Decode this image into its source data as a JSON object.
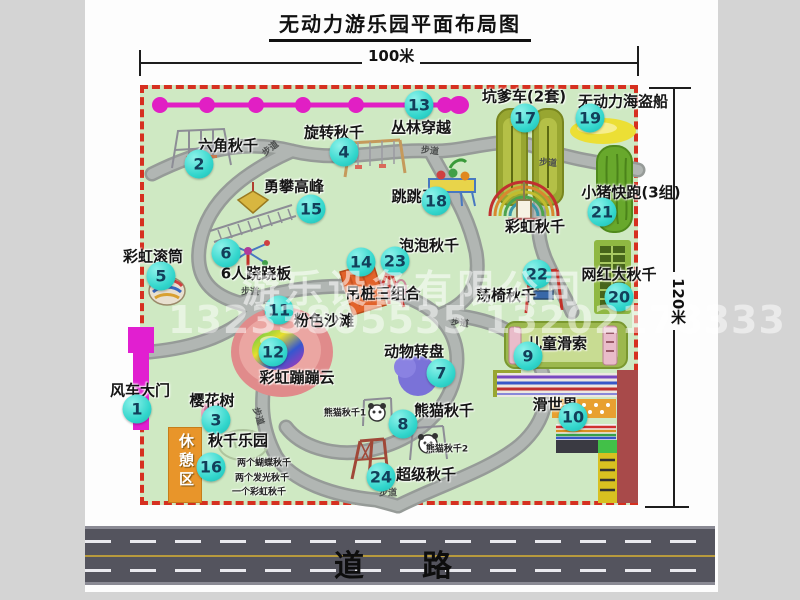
{
  "title": "无动力游乐园平面布局图",
  "dim_top": "100米",
  "dim_right": "120米",
  "road_label": "道　路",
  "trail_label": "步道",
  "rest_area_label": "休憩区",
  "watermark": {
    "company": "游乐设备有限公司",
    "phone": "13233805535 13202178333"
  },
  "attractions": [
    {
      "id": "windmill-gate",
      "num": "1",
      "label": "风车大门",
      "lx": 140,
      "ly": 390,
      "cx": 137,
      "cy": 409
    },
    {
      "id": "hex-swing",
      "num": "2",
      "label": "六角秋千",
      "lx": 228,
      "ly": 145,
      "cx": 199,
      "cy": 164
    },
    {
      "id": "cherry-tree",
      "num": "3",
      "label": "樱花树",
      "lx": 212,
      "ly": 400,
      "cx": 216,
      "cy": 420
    },
    {
      "id": "rotating-swing",
      "num": "4",
      "label": "旋转秋千",
      "lx": 334,
      "ly": 132,
      "cx": 344,
      "cy": 152
    },
    {
      "id": "rainbow-roller",
      "num": "5",
      "label": "彩虹滚筒",
      "lx": 153,
      "ly": 256,
      "cx": 161,
      "cy": 276
    },
    {
      "id": "six-seesaw",
      "num": "6",
      "label": "6人跷跷板",
      "lx": 256,
      "ly": 273,
      "cx": 226,
      "cy": 253
    },
    {
      "id": "animal-turntable",
      "num": "7",
      "label": "动物转盘",
      "lx": 414,
      "ly": 351,
      "cx": 441,
      "cy": 373
    },
    {
      "id": "panda-swing",
      "num": "8",
      "label": "熊猫秋千",
      "lx": 444,
      "ly": 410,
      "cx": 403,
      "cy": 424
    },
    {
      "id": "kids-zipline",
      "num": "9",
      "label": "儿童滑索",
      "lx": 557,
      "ly": 343,
      "cx": 528,
      "cy": 356
    },
    {
      "id": "slide-world",
      "num": "10",
      "label": "滑世界",
      "lx": 555,
      "ly": 404,
      "cx": 573,
      "cy": 417
    },
    {
      "id": "pink-beach",
      "num": "11",
      "label": "粉色沙滩",
      "lx": 324,
      "ly": 320,
      "cx": 279,
      "cy": 310
    },
    {
      "id": "rainbow-bounce-cloud",
      "num": "12",
      "label": "彩虹蹦蹦云",
      "lx": 297,
      "ly": 377,
      "cx": 273,
      "cy": 352
    },
    {
      "id": "jungle-crossing",
      "num": "13",
      "label": "丛林穿越",
      "lx": 421,
      "ly": 127,
      "cx": 419,
      "cy": 105
    },
    {
      "id": "hanging-piles-combo",
      "num": "14",
      "label": "吊桩三组合",
      "lx": 383,
      "ly": 293,
      "cx": 361,
      "cy": 262
    },
    {
      "id": "peak-climbing",
      "num": "15",
      "label": "勇攀高峰",
      "lx": 294,
      "ly": 186,
      "cx": 311,
      "cy": 209
    },
    {
      "id": "swing-park",
      "num": "16",
      "label": "秋千乐园",
      "lx": 238,
      "ly": 440,
      "cx": 211,
      "cy": 467
    },
    {
      "id": "pit-car",
      "num": "17",
      "label": "坑爹车(2套)",
      "lx": 524,
      "ly": 96,
      "cx": 525,
      "cy": 118
    },
    {
      "id": "jumping-horse",
      "num": "18",
      "label": "跳跳马",
      "lx": 414,
      "ly": 196,
      "cx": 436,
      "cy": 201
    },
    {
      "id": "pirate-ship",
      "num": "19",
      "label": "无动力海盗船",
      "lx": 623,
      "ly": 101,
      "cx": 590,
      "cy": 118
    },
    {
      "id": "big-swing",
      "num": "20",
      "label": "网红大秋千",
      "lx": 619,
      "ly": 274,
      "cx": 619,
      "cy": 297
    },
    {
      "id": "piggy-run",
      "num": "21",
      "label": "小猪快跑(3组)",
      "lx": 631,
      "ly": 192,
      "cx": 602,
      "cy": 212
    },
    {
      "id": "swing-chair",
      "num": "22",
      "label": "荡椅秋千",
      "lx": 506,
      "ly": 295,
      "cx": 537,
      "cy": 274
    },
    {
      "id": "bubble-swing",
      "num": "23",
      "label": "泡泡秋千",
      "lx": 429,
      "ly": 245,
      "cx": 395,
      "cy": 261
    },
    {
      "id": "super-swing",
      "num": "24",
      "label": "超级秋千",
      "lx": 426,
      "ly": 474,
      "cx": 381,
      "cy": 477
    },
    {
      "id": "rainbow-swing",
      "num": "",
      "label": "彩虹秋千",
      "lx": 535,
      "ly": 226,
      "cx": 0,
      "cy": 0
    },
    {
      "id": "panda-swing-note-1",
      "num": "",
      "label": "熊猫秋千1",
      "lx": 345,
      "ly": 412,
      "cx": 0,
      "cy": 0,
      "small": true
    },
    {
      "id": "panda-swing-note-2",
      "num": "",
      "label": "熊猫秋千2",
      "lx": 447,
      "ly": 448,
      "cx": 0,
      "cy": 0,
      "small": true
    },
    {
      "id": "swing-park-note-1",
      "num": "",
      "label": "两个蝴蝶秋千",
      "lx": 264,
      "ly": 462,
      "cx": 0,
      "cy": 0,
      "small": true
    },
    {
      "id": "swing-park-note-2",
      "num": "",
      "label": "两个发光秋千",
      "lx": 262,
      "ly": 477,
      "cx": 0,
      "cy": 0,
      "small": true
    },
    {
      "id": "swing-park-note-3",
      "num": "",
      "label": "一个彩虹秋千",
      "lx": 259,
      "ly": 491,
      "cx": 0,
      "cy": 0,
      "small": true
    }
  ],
  "trail_labels": [
    {
      "x": 270,
      "y": 148,
      "rot": -38
    },
    {
      "x": 430,
      "y": 150,
      "rot": 6
    },
    {
      "x": 548,
      "y": 162,
      "rot": 4
    },
    {
      "x": 250,
      "y": 291,
      "rot": 0
    },
    {
      "x": 460,
      "y": 322,
      "rot": 8
    },
    {
      "x": 259,
      "y": 416,
      "rot": 72
    },
    {
      "x": 388,
      "y": 492,
      "rot": 0
    }
  ]
}
